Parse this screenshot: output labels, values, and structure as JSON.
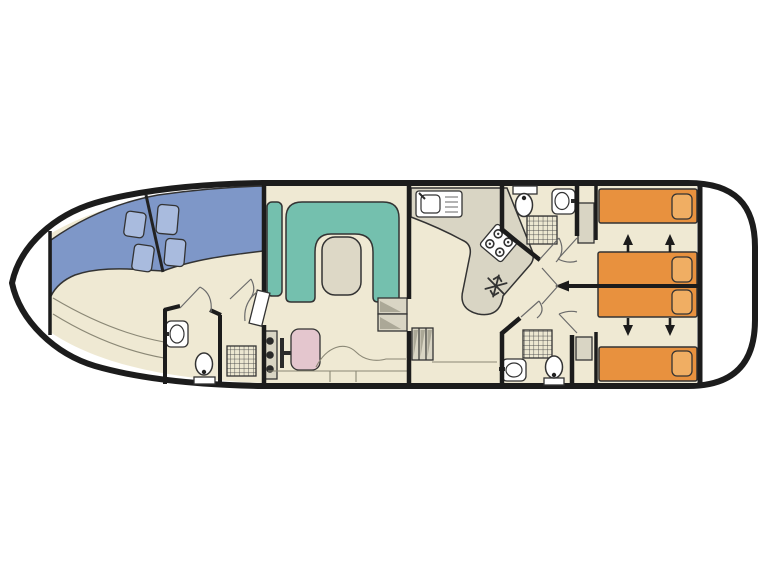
{
  "title": "",
  "colors": {
    "background": "#ffffff",
    "deck_white": "#ffffff",
    "hull_outline": "#1c1c1c",
    "interior_floor": "#efe9d3",
    "wall": "#1c1c1c",
    "bed_blue": "#7e97c8",
    "pillow_blue": "#a9bbde",
    "sofa_teal": "#74c0ae",
    "table_gray": "#ddd8c6",
    "counter_gray": "#d9d5c4",
    "step_shade": "#aba897",
    "bed_orange": "#e8913e",
    "pillow_orange": "#f0ae63",
    "seat_pink": "#e4c6ce",
    "fixture_white": "#ffffff",
    "shower_floor": "#ece7d1",
    "knob_dark": "#2a2a2a",
    "door_white": "#ffffff",
    "arrow_black": "#1c1c1c"
  },
  "counts": {
    "bow_double_beds": 2,
    "bow_pillows": 4,
    "stern_single_beds": 4,
    "stern_pillows": 4,
    "bed_convert_arrows_up": 2,
    "bed_convert_arrows_down": 2,
    "bathrooms": 3,
    "showers": 3,
    "toilets": 3,
    "washbasins": 3,
    "kitchen_sinks": 1,
    "stove_burners": 4,
    "fridge_snowflake_icons": 1,
    "helm_knobs": 3,
    "saloon_tables": 1,
    "step_flights": 2,
    "wardrobes": 2
  }
}
